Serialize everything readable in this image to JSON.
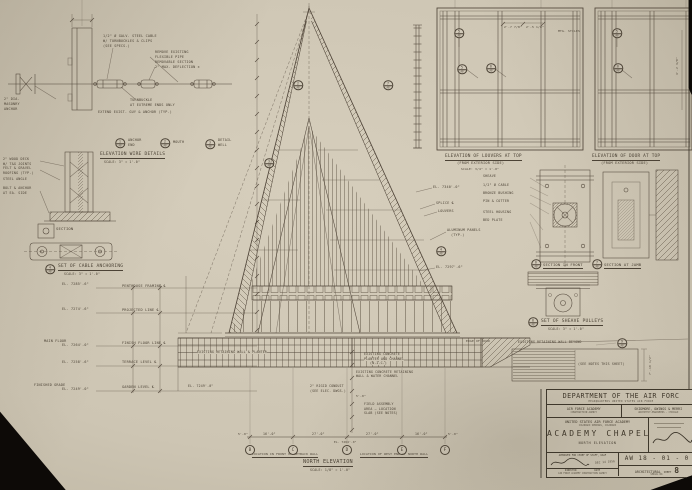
{
  "colors": {
    "paper": "#cdc5b3",
    "ink": "#4c4336",
    "background": "#0d0a07"
  },
  "title_block": {
    "department": "DEPARTMENT OF THE AIR FORC",
    "headquarters": "HEADQUARTERS UNITED STATES AIR FORCE",
    "agency": "AIR FORCE ACADEMY",
    "agency_sub": "CONSTRUCTION AGENCY",
    "architect": "SKIDMORE, OWINGS & MERRI",
    "architect_sub": "ARCHITECT-ENGINEERS · CHICAGO",
    "project": "UNITED STATES AIR FORCE ACADEMY",
    "location": "COLORADO SPRINGS, COLORADO",
    "title": "ACADEMY CHAPEL",
    "view": "NORTH ELEVATION",
    "approved": "APPROVED FOR CHIEF OF STAFF, USAF",
    "approved_date": "DEC 14 1956",
    "director_label": "DIRECTOR",
    "date_label": "DATE",
    "agency_footer": "AIR FORCE ACADEMY CONSTRUCTION AGENCY",
    "drawing_no": "AW 18 - 01 - 0",
    "discipline": "ARCHITECTURAL",
    "sheet_label": "SHEET",
    "sheet_no": "8",
    "serial_label": "SERIAL NO."
  },
  "grid_bubbles": {
    "y": 450,
    "items": [
      {
        "x": 250,
        "t": "B"
      },
      {
        "x": 293,
        "t": "C"
      },
      {
        "x": 347,
        "t": "D"
      },
      {
        "x": 402,
        "t": "E"
      },
      {
        "x": 445,
        "t": "F"
      }
    ]
  },
  "callouts": [
    {
      "x": 120,
      "y": 143,
      "a": "1",
      "b": "A8"
    },
    {
      "x": 165,
      "y": 143,
      "a": "2",
      "b": "A8"
    },
    {
      "x": 210,
      "y": 144,
      "a": "3",
      "b": "A8"
    },
    {
      "x": 50,
      "y": 269,
      "a": "4",
      "b": "A8"
    },
    {
      "x": 298,
      "y": 85,
      "a": "2",
      "b": "A8"
    },
    {
      "x": 269,
      "y": 163,
      "a": "3",
      "b": "A8"
    },
    {
      "x": 388,
      "y": 85,
      "a": "7",
      "b": "A8"
    },
    {
      "x": 441,
      "y": 251,
      "a": "4",
      "b": "A8"
    },
    {
      "x": 459,
      "y": 33,
      "a": "5",
      "b": "A8"
    },
    {
      "x": 462,
      "y": 69,
      "a": "5",
      "b": "A8"
    },
    {
      "x": 491,
      "y": 68,
      "a": "6",
      "b": "A8"
    },
    {
      "x": 617,
      "y": 33,
      "a": "5",
      "b": "A8"
    },
    {
      "x": 618,
      "y": 68,
      "a": "6",
      "b": "A8"
    },
    {
      "x": 533,
      "y": 322,
      "a": "8",
      "b": "A8"
    },
    {
      "x": 536,
      "y": 264,
      "a": "6",
      "b": "A8"
    },
    {
      "x": 597,
      "y": 264,
      "a": "7",
      "b": "A8"
    },
    {
      "x": 622,
      "y": 343,
      "a": "9",
      "b": "A8"
    }
  ],
  "annotations": [
    {
      "t": "1/2\" Ø GALV. STEEL CABLE",
      "x": 103,
      "y": 35
    },
    {
      "t": "W/ TURNBUCKLES & CLIPS",
      "x": 103,
      "y": 40
    },
    {
      "t": "(SEE SPECS.)",
      "x": 103,
      "y": 45
    },
    {
      "t": "REMOVE EXISTING",
      "x": 155,
      "y": 51
    },
    {
      "t": "FLEXIBLE PIPE",
      "x": 155,
      "y": 56
    },
    {
      "t": "REMOVABLE SECTION",
      "x": 155,
      "y": 61
    },
    {
      "t": "2\" MAX. DEFLECTION ±",
      "x": 155,
      "y": 66
    },
    {
      "t": "2\" DIA.",
      "x": 4,
      "y": 98
    },
    {
      "t": "MASONRY",
      "x": 4,
      "y": 103
    },
    {
      "t": "ANCHOR",
      "x": 4,
      "y": 108
    },
    {
      "t": "TURNBUCKLE",
      "x": 130,
      "y": 99
    },
    {
      "t": "AT EXTREME ENDS ONLY",
      "x": 130,
      "y": 104
    },
    {
      "t": "EXTEND EXIST. GUY & ANCHOR (TYP.)",
      "x": 98,
      "y": 111
    },
    {
      "t": "ANCHOR",
      "x": 128,
      "y": 139
    },
    {
      "t": "END",
      "x": 128,
      "y": 144
    },
    {
      "t": "MOUTH",
      "x": 173,
      "y": 141
    },
    {
      "t": "DETAIL",
      "x": 218,
      "y": 139
    },
    {
      "t": "WELL",
      "x": 218,
      "y": 144
    },
    {
      "n": "caption-wire-details",
      "t": "ELEVATION WIRE DETAILS",
      "x": 100,
      "y": 153,
      "fs": 4.6,
      "u": 1
    },
    {
      "t": "SCALE: 3\" = 1'-0\"",
      "x": 104,
      "y": 161,
      "fs": 3.2
    },
    {
      "t": "2\" WOOD DECK",
      "x": 3,
      "y": 158,
      "fs": 3.3
    },
    {
      "t": "W/ T&G JOINTS",
      "x": 3,
      "y": 162.5,
      "fs": 3.3
    },
    {
      "t": "FELT & GRAVEL",
      "x": 3,
      "y": 167,
      "fs": 3.3
    },
    {
      "t": "ROOFING (TYP.)",
      "x": 3,
      "y": 171.5,
      "fs": 3.3
    },
    {
      "t": "STEEL ANGLE",
      "x": 3,
      "y": 178,
      "fs": 3.3
    },
    {
      "t": "BOLT & ANCHOR",
      "x": 3,
      "y": 187,
      "fs": 3.3
    },
    {
      "t": "AT EA. SIDE",
      "x": 3,
      "y": 191.5,
      "fs": 3.3
    },
    {
      "t": "SECTION",
      "x": 56,
      "y": 227,
      "fs": 3.8
    },
    {
      "n": "caption-cable-anchoring",
      "t": "SET OF CABLE ANCHORING",
      "x": 58,
      "y": 265,
      "fs": 4.6,
      "u": 1
    },
    {
      "t": "SCALE: 3\" = 1'-0\"",
      "x": 64,
      "y": 273,
      "fs": 3.2
    },
    {
      "t": "EL. 7285'-6\"",
      "x": 62,
      "y": 283
    },
    {
      "t": "EL. 7274'-6\"",
      "x": 62,
      "y": 308
    },
    {
      "t": "MAIN FLOOR",
      "x": 44,
      "y": 340
    },
    {
      "t": "EL. 7264'-0\"",
      "x": 62,
      "y": 344
    },
    {
      "t": "EL. 7258'-6\"",
      "x": 62,
      "y": 361
    },
    {
      "t": "FINISHED GRADE",
      "x": 34,
      "y": 384
    },
    {
      "t": "EL. 7249'-0\"",
      "x": 62,
      "y": 388
    },
    {
      "t": "PENTHOUSE FRAMING ℄",
      "x": 122,
      "y": 285,
      "fs": 3.5
    },
    {
      "t": "PROJECTED LINE ℄",
      "x": 122,
      "y": 309,
      "fs": 3.5
    },
    {
      "t": "FINISH FLOOR LINE ℄",
      "x": 122,
      "y": 342,
      "fs": 3.5
    },
    {
      "t": "TERRACE LEVEL ℄",
      "x": 122,
      "y": 361,
      "fs": 3.5
    },
    {
      "t": "GARDEN LEVEL ℄",
      "x": 122,
      "y": 386,
      "fs": 3.5
    },
    {
      "t": "EL. 7340'-0\"",
      "x": 433,
      "y": 186
    },
    {
      "t": "SPLICE ℄",
      "x": 436,
      "y": 202
    },
    {
      "t": "LOUVERS",
      "x": 438,
      "y": 210
    },
    {
      "t": "ALUMINUM PANELS",
      "x": 447,
      "y": 229
    },
    {
      "t": "(TYP.)",
      "x": 451,
      "y": 233.5
    },
    {
      "t": "EL. 7297'-6\"",
      "x": 436,
      "y": 266
    },
    {
      "n": "caption-louvers-elevation",
      "t": "ELEVATION OF LOUVERS AT TOP",
      "x": 445,
      "y": 155,
      "fs": 4.4,
      "u": 1
    },
    {
      "t": "(FROM EXTERIOR SIDE)",
      "x": 457,
      "y": 162,
      "fs": 3.6
    },
    {
      "t": "SCALE: 3/4\" = 1'-0\"",
      "x": 461,
      "y": 167.5,
      "fs": 3
    },
    {
      "n": "caption-door-elevation",
      "t": "ELEVATION OF DOOR AT TOP",
      "x": 592,
      "y": 155,
      "fs": 4.4,
      "u": 1
    },
    {
      "t": "(FROM EXTERIOR SIDE)",
      "x": 601,
      "y": 162,
      "fs": 3.6
    },
    {
      "t": "2'-7 7/8\"",
      "x": 504,
      "y": 26,
      "fs": 3
    },
    {
      "t": "2'-5 1/8\"",
      "x": 526,
      "y": 26,
      "fs": 3
    },
    {
      "t": "4'-2 3/8\"",
      "x": 676,
      "y": 75,
      "fs": 3,
      "r": -90
    },
    {
      "t": "MTG. STILES",
      "x": 558,
      "y": 30,
      "fs": 3
    },
    {
      "t": "SHEAVE",
      "x": 483,
      "y": 175,
      "fs": 3.3
    },
    {
      "t": "1/2\" Ø CABLE",
      "x": 483,
      "y": 184,
      "fs": 3.3
    },
    {
      "t": "BRONZE BUSHING",
      "x": 483,
      "y": 192,
      "fs": 3.3
    },
    {
      "t": "PIN & COTTER",
      "x": 483,
      "y": 200,
      "fs": 3.3
    },
    {
      "t": "STEEL HOUSING",
      "x": 483,
      "y": 211,
      "fs": 3.3
    },
    {
      "t": "BED PLATE",
      "x": 483,
      "y": 219,
      "fs": 3.3
    },
    {
      "t": "SECTION IN FRONT",
      "x": 543,
      "y": 263,
      "fs": 3.8,
      "u": 1
    },
    {
      "t": "SECTION AT JAMB",
      "x": 604,
      "y": 263,
      "fs": 3.8,
      "u": 1
    },
    {
      "n": "caption-sheave-pulleys",
      "t": "SET OF SHEAVE PULLEYS",
      "x": 541,
      "y": 320,
      "fs": 4.6,
      "u": 1
    },
    {
      "t": "SCALE: 3\" = 1'-0\"",
      "x": 548,
      "y": 328,
      "fs": 3.2
    },
    {
      "t": "EXISTING RETAINING WALL BEYOND",
      "x": 518,
      "y": 341,
      "fs": 3.2
    },
    {
      "t": "(SEE NOTES THIS SHEET)",
      "x": 578,
      "y": 363,
      "fs": 3.2
    },
    {
      "t": "7'-10 1/2\"",
      "x": 649,
      "y": 375,
      "fs": 3,
      "r": -90
    },
    {
      "t": "EXISTING RETAINING WALL & PLANTER",
      "x": 197,
      "y": 351,
      "fs": 3.2,
      "bg": 1
    },
    {
      "t": "EL. 7249'-0\"",
      "x": 188,
      "y": 385,
      "fs": 3.2
    },
    {
      "t": "EXISTING CONCRETE",
      "x": 364,
      "y": 353,
      "fs": 3.2,
      "bg": 1
    },
    {
      "t": "PLANTER AND CHANNEL",
      "x": 364,
      "y": 357.5,
      "fs": 3.2,
      "bg": 1
    },
    {
      "t": "(N.I.C.)",
      "x": 370,
      "y": 362,
      "fs": 3.2,
      "bg": 1
    },
    {
      "t": "EXISTING CONCRETE RETAINING",
      "x": 356,
      "y": 370.5,
      "fs": 3.2
    },
    {
      "t": "WALL & WATER CHANNEL",
      "x": 356,
      "y": 375,
      "fs": 3.2
    },
    {
      "t": "2\" RIGID CONDUIT",
      "x": 310,
      "y": 385,
      "fs": 3.2
    },
    {
      "t": "(SEE ELEC. DWGS.)",
      "x": 310,
      "y": 389.5,
      "fs": 3.2
    },
    {
      "t": "5'-0\"",
      "x": 356,
      "y": 395,
      "fs": 3
    },
    {
      "t": "FIELD ASSEMBLY",
      "x": 364,
      "y": 403,
      "fs": 3.2
    },
    {
      "t": "AREA — LOCATION",
      "x": 364,
      "y": 407.5,
      "fs": 3.2
    },
    {
      "t": "SLAB (SEE NOTES)",
      "x": 364,
      "y": 412,
      "fs": 3.2
    },
    {
      "t": "EDGE OF ROAD",
      "x": 466,
      "y": 340,
      "fs": 3
    },
    {
      "t": "5'-0\"",
      "x": 238,
      "y": 433,
      "fs": 3
    },
    {
      "t": "16'-0\"",
      "x": 263,
      "y": 433,
      "fs": 3.2
    },
    {
      "t": "27'-0\"",
      "x": 312,
      "y": 433,
      "fs": 3.2
    },
    {
      "t": "27'-0\"",
      "x": 366,
      "y": 433,
      "fs": 3.2
    },
    {
      "t": "16'-0\"",
      "x": 415,
      "y": 433,
      "fs": 3.2
    },
    {
      "t": "5'-0\"",
      "x": 448,
      "y": 433,
      "fs": 3
    },
    {
      "t": "EL. 7264'-0\"",
      "x": 334,
      "y": 441,
      "fs": 2.8
    },
    {
      "t": "LOCATION IN FRONT OF SETBACK WALL",
      "x": 252,
      "y": 453,
      "fs": 3,
      "u": 1
    },
    {
      "t": "LOCATION OF WEST END OF NORTH WALL",
      "x": 360,
      "y": 453,
      "fs": 3,
      "u": 1
    },
    {
      "n": "caption-north-elevation",
      "t": "NORTH ELEVATION",
      "x": 303,
      "y": 460,
      "fs": 5.2,
      "u": 1
    },
    {
      "t": "SCALE: 1/8\" = 1'-0\"",
      "x": 310,
      "y": 469,
      "fs": 3.2
    }
  ]
}
